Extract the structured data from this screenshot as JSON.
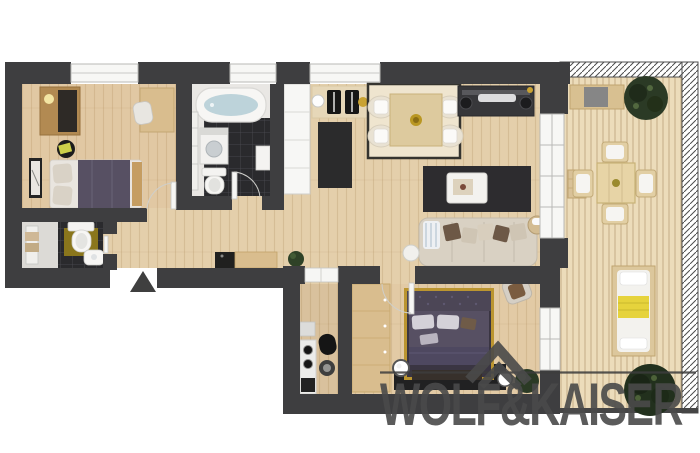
{
  "logo": {
    "text": "WOLF&KAISER",
    "icon": "roof-chevrons-icon",
    "color": "#4a4a4a"
  },
  "palette": {
    "background": "#ffffff",
    "wall": "#3e3e40",
    "floor_wood": "#e4cfab",
    "deck": "#ecdcba",
    "tile_dark": "#2a2a2d",
    "rug_dark": "#2d2c2f",
    "rug_light": "#efe5cf",
    "sofa": "#d9d1c3",
    "bed_purple": "#575063",
    "gold": "#c9a232",
    "yellow": "#e6d33c",
    "plant": "#2b3a25",
    "water": "#bdd3da",
    "wood_furniture": "#d9bd8e",
    "dark_furniture": "#1f1f20",
    "olive_mat": "#8a761c",
    "logo": "#4a4a4a"
  },
  "rooms": [
    {
      "name": "bedroom-1",
      "furniture": [
        "wardrobe",
        "desk",
        "chair",
        "double-bed",
        "side-table",
        "picture-frame"
      ]
    },
    {
      "name": "bathroom",
      "furniture": [
        "bathtub",
        "washing-machine",
        "toilet",
        "radiator",
        "wall-cabinet"
      ]
    },
    {
      "name": "wc",
      "furniture": [
        "toilet",
        "hand-basin",
        "towel-radiator"
      ]
    },
    {
      "name": "hallway",
      "furniture": [
        "tall-cabinet",
        "sideboard",
        "plant"
      ]
    },
    {
      "name": "living-dining-room",
      "furniture": [
        "dining-table",
        "dining-chairs",
        "work-desk",
        "desk-chairs",
        "tv-sideboard",
        "coffee-table",
        "corner-sofa",
        "blanket-basket",
        "side-lamp"
      ]
    },
    {
      "name": "kitchen",
      "furniture": [
        "stove-oven",
        "chair",
        "stool"
      ]
    },
    {
      "name": "bedroom-2",
      "furniture": [
        "wardrobe",
        "double-bed",
        "floor-lamps",
        "foot-bench",
        "chair",
        "plant"
      ]
    },
    {
      "name": "balcony",
      "furniture": [
        "bench",
        "outdoor-dining-set",
        "lounger",
        "plants",
        "side-table",
        "railing"
      ]
    }
  ],
  "markers": {
    "entrance": "triangle-arrow"
  }
}
